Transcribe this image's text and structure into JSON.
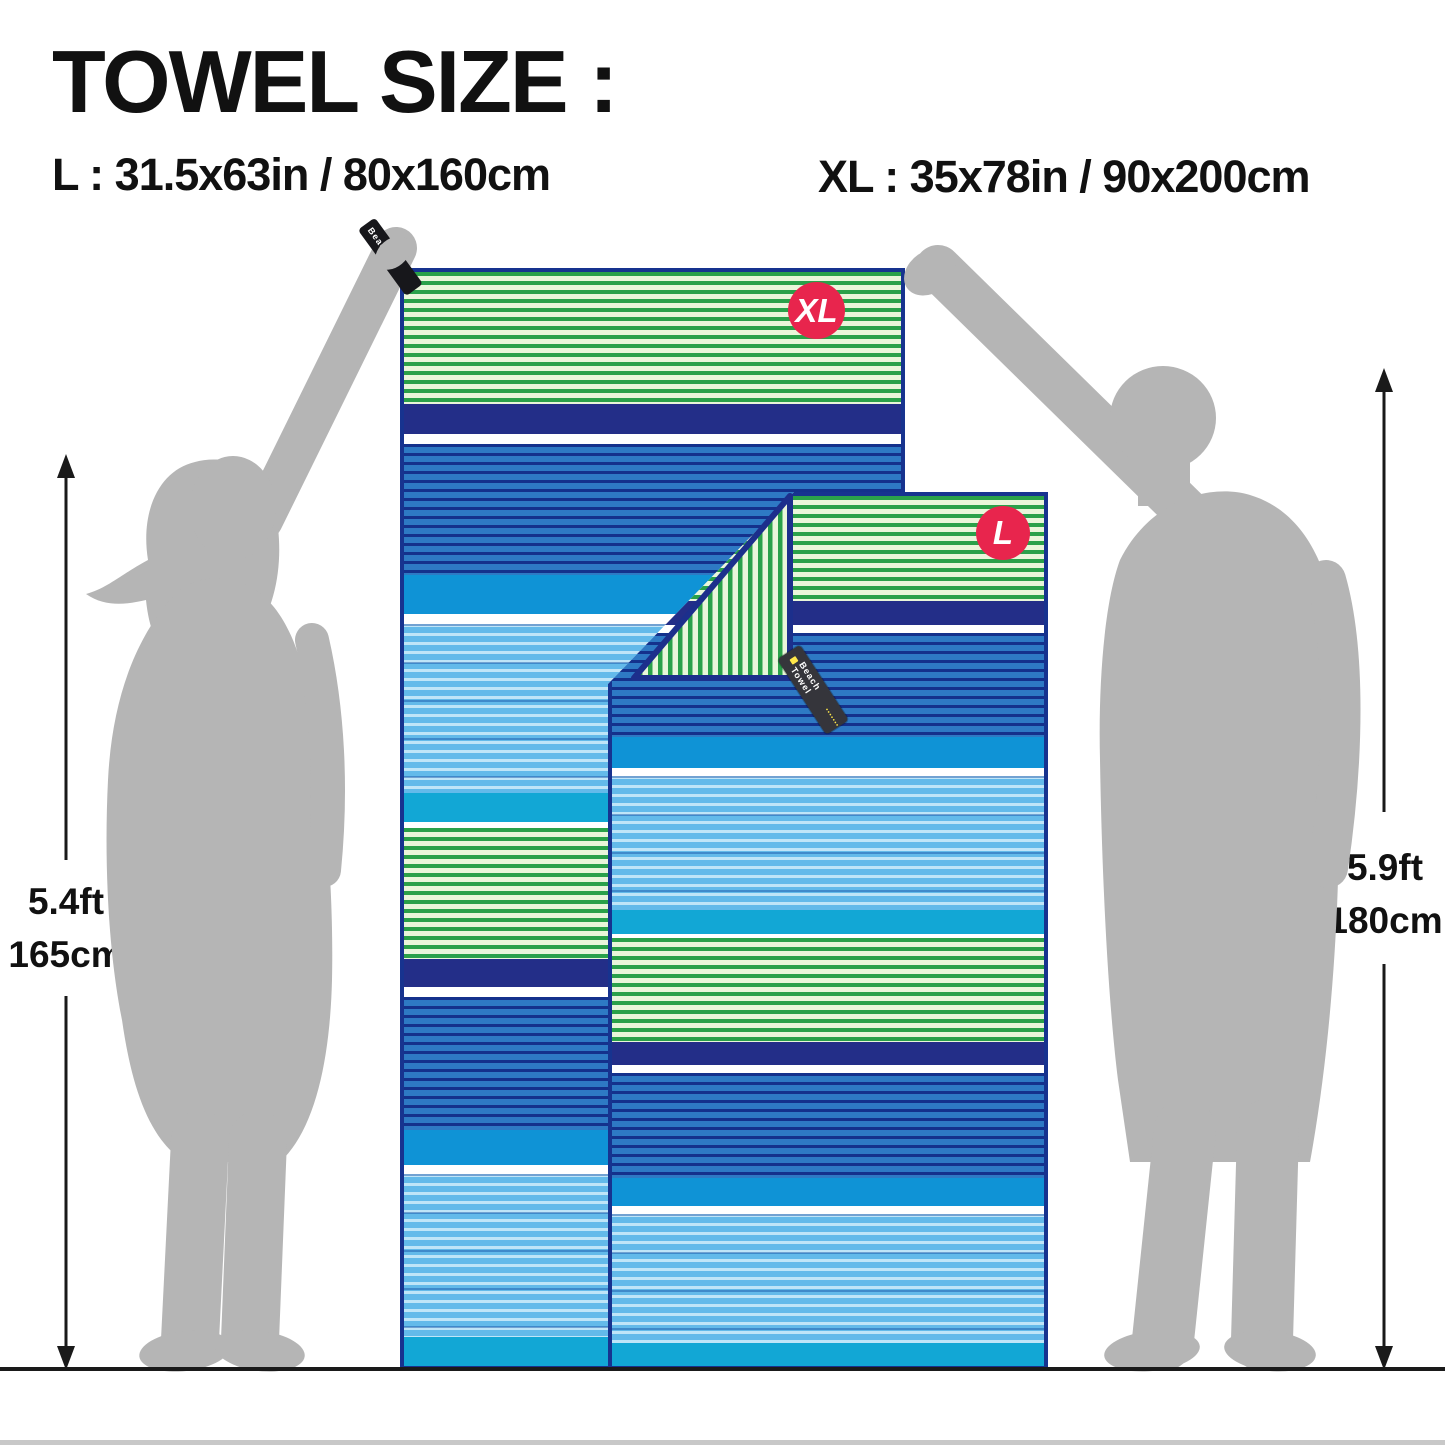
{
  "title": "TOWEL SIZE :",
  "size_lines": {
    "l": "L : 31.5x63in / 80x160cm",
    "xl": "XL : 35x78in / 90x200cm"
  },
  "measurements": {
    "left": {
      "feet": "5.4ft",
      "cm": "165cm"
    },
    "right": {
      "feet": "5.9ft",
      "cm": "180cm"
    }
  },
  "towels": {
    "xl": {
      "badge": "XL",
      "hang_tag": "Beach"
    },
    "l": {
      "badge": "L",
      "zipper_tag": "Beach Towel"
    }
  },
  "colors": {
    "badge_red": "#e8254d",
    "towel_border_navy": "#17338f",
    "band_navy": "#232e88",
    "band_azure": "#0f93d6",
    "band_cyan": "#12a7d5",
    "green_stripe": "#2aa14a",
    "green_bg": "#e9f6da",
    "blue_bg": "#2e79c4",
    "sky_bg": "#63baea",
    "silhouette_gray": "#b5b5b5"
  },
  "towel_pattern": [
    {
      "band": "green",
      "h": 12.1
    },
    {
      "band": "navy",
      "h": 2.7
    },
    {
      "band": "white",
      "h": 0.9
    },
    {
      "band": "blue",
      "h": 12.0
    },
    {
      "band": "azure",
      "h": 3.6
    },
    {
      "band": "white",
      "h": 0.9
    },
    {
      "band": "sky",
      "h": 15.4
    },
    {
      "band": "cyan",
      "h": 2.7
    },
    {
      "band": "white",
      "h": 0.5
    },
    {
      "band": "green",
      "h": 12.0
    },
    {
      "band": "navy",
      "h": 2.6
    },
    {
      "band": "white",
      "h": 0.9
    },
    {
      "band": "blue",
      "h": 12.1
    },
    {
      "band": "azure",
      "h": 3.2
    },
    {
      "band": "white",
      "h": 0.9
    },
    {
      "band": "sky",
      "h": 14.9
    },
    {
      "band": "cyan",
      "h": 2.6
    }
  ]
}
